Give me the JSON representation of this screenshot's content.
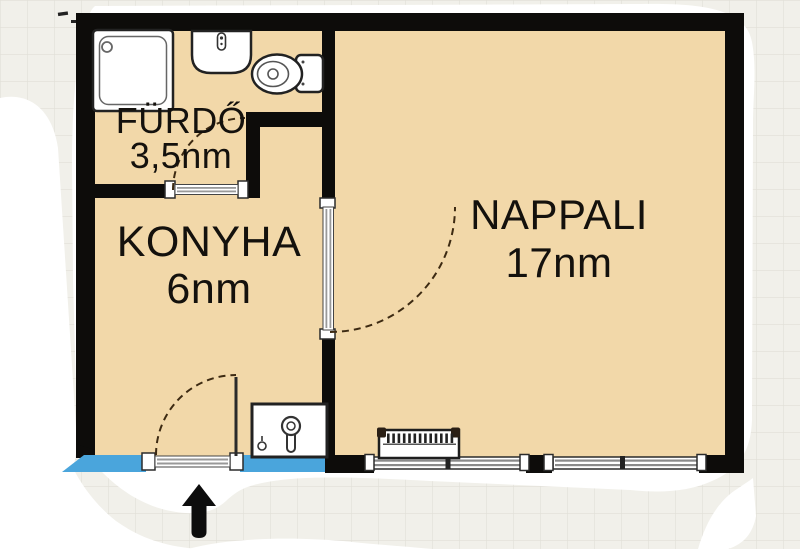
{
  "page": {
    "type": "apartment floor plan"
  },
  "rooms": {
    "bathroom": {
      "name": "FÜRDŐ",
      "area": "3,5nm"
    },
    "kitchen": {
      "name": "KONYHA",
      "area": "6nm"
    },
    "living_room": {
      "name": "NAPPALI",
      "area": "17nm"
    }
  },
  "fixtures": {
    "bathroom": [
      "shower-icon",
      "washbasin-icon",
      "toilet-icon"
    ],
    "kitchen": [
      "kitchen-sink-icon"
    ],
    "living_room": [
      "radiator-icon"
    ],
    "entrance": [
      "entrance-arrow-icon"
    ]
  },
  "colors": {
    "floor": "#f2d8a9",
    "wall": "#0d0c0a",
    "window_blue": "#4aa5dc",
    "paper": "#ffffff",
    "grid_bg": "#f1f0ea",
    "grid_line": "#e1dfd8",
    "door_arc": "#3d2a12"
  }
}
